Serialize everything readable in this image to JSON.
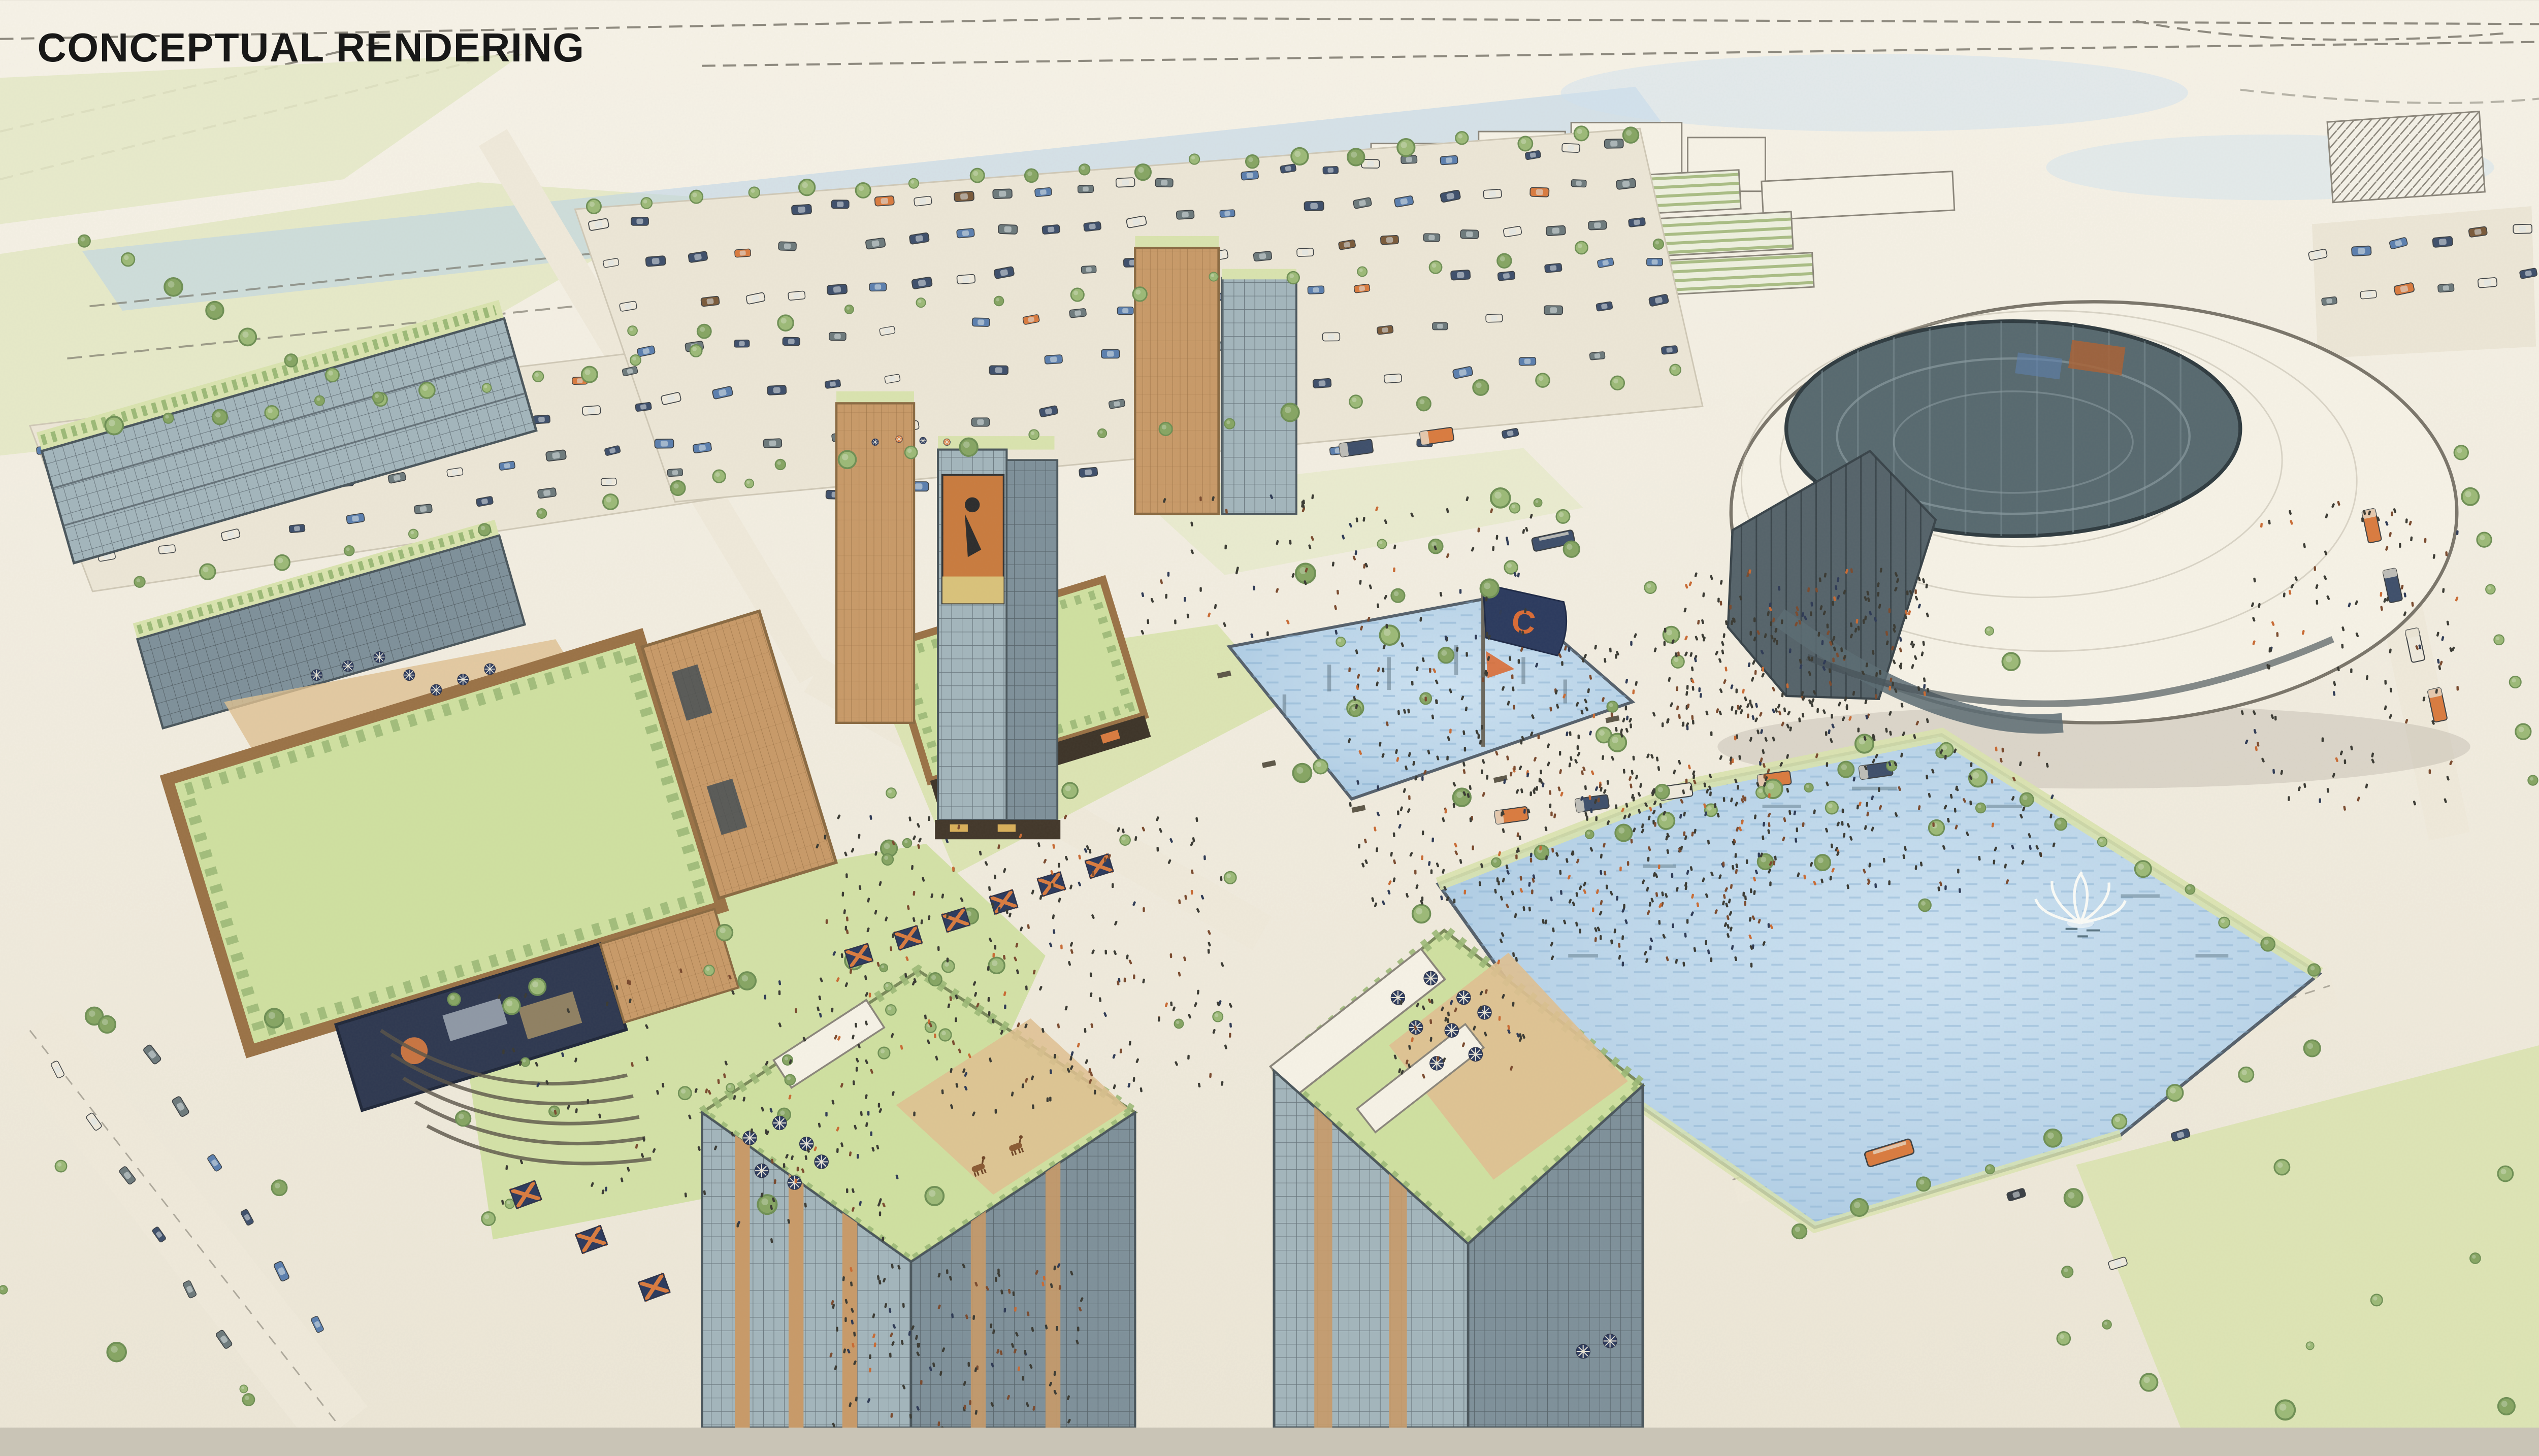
{
  "watermark": {
    "label": "CONCEPTUAL RENDERING"
  },
  "flag": {
    "letter": "C"
  },
  "elements": {
    "stadium": "domed stadium with open oculus",
    "big_lake": "large lake with fountain",
    "plaza_pond": "rectangular reflecting pond",
    "team_flag": "navy team flag with orange C",
    "parking": "surface parking lots with rows of cars",
    "mixed_use": "mixed-use glass and timber buildings with green roofs",
    "rooftop_terraces": "rooftop decks with blue umbrellas",
    "market_stalls": "striped market canopies on promenade",
    "food_trucks": "food trucks along lake shore",
    "amphitheater": "lawn amphitheater steps",
    "crowds": "crowds of pedestrians",
    "jumbotron": "large video screen on timber building",
    "player_banner": "football player banner on glass tower",
    "orange_bus": "orange shuttle bus on lakeside road"
  },
  "palette": {
    "paper": "#f1ecdf",
    "paper_light": "#f7f3e8",
    "line": "#6b675c",
    "water": "#b9d4e9",
    "water_deep": "#9cc0dd",
    "sky_wash": "#cfe2ef",
    "lawn": "#d9e3ae",
    "lawn_bright": "#cfe0a0",
    "field": "#e6e9c8",
    "tree": "#9cb977",
    "tree_dark": "#6e8f54",
    "glass": "#a3b5bc",
    "glass_dark": "#7e909a",
    "mullion": "#4a565c",
    "timber": "#c89a68",
    "timber_dark": "#9a7246",
    "roof_white": "#f6f2e6",
    "bowl": "#57696f",
    "bowl_rim": "#2f3b40",
    "asphalt": "#ece6d6",
    "road": "#efe9da",
    "deck": "#dfc091",
    "car_navy": "#3e4f6b",
    "car_slate": "#6d7a7c",
    "car_blue": "#5b7fae",
    "car_white": "#eee9dc",
    "accent_orange": "#d97b3f",
    "flag_navy": "#2b3a5e",
    "flag_orange": "#d96b35",
    "crowd_dark": "#3a3a33",
    "crowd_warm": "#7a4a2e",
    "crowd_navy": "#2e3a55",
    "screen_navy": "#2e3850",
    "shadow": "#8b857a"
  }
}
